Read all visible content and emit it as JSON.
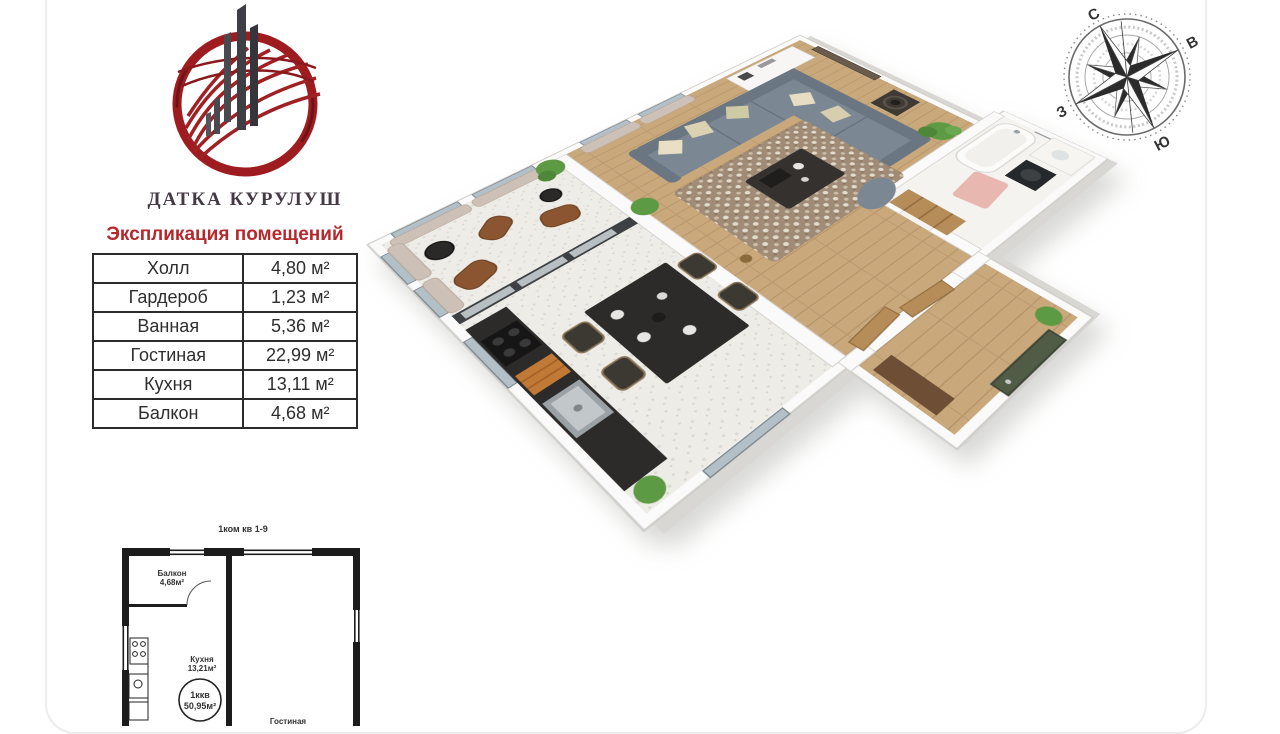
{
  "logo": {
    "company": "ДАТКА КУРУЛУШ"
  },
  "explication": {
    "title": "Экспликация помещений",
    "rows": [
      {
        "name": "Холл",
        "area": "4,80 м²"
      },
      {
        "name": "Гардероб",
        "area": "1,23 м²"
      },
      {
        "name": "Ванная",
        "area": "5,36 м²"
      },
      {
        "name": "Гостиная",
        "area": "22,99 м²"
      },
      {
        "name": "Кухня",
        "area": "13,11 м²"
      },
      {
        "name": "Балкон",
        "area": "4,68 м²"
      }
    ]
  },
  "compass": {
    "north": "С",
    "east": "В",
    "south": "Ю",
    "west": "З"
  },
  "mini_plan": {
    "title": "1ком кв 1-9",
    "balcony_label": "Балкон",
    "balcony_area": "4,68м²",
    "kitchen_label": "Кухня",
    "kitchen_area": "13,21м²",
    "apartment_type": "1ккв",
    "total_area": "50,95м²",
    "living_label": "Гостиная"
  },
  "colors": {
    "accent_red": "#b5282c",
    "logo_red": "#9e1c20",
    "wall_white": "#fbfafa",
    "wood_floor": "#c9a87c",
    "sofa_gray": "#78848f",
    "curtain_taupe": "#cdc0b6",
    "door_green": "#515c47",
    "table_border": "#2b2b2b"
  }
}
